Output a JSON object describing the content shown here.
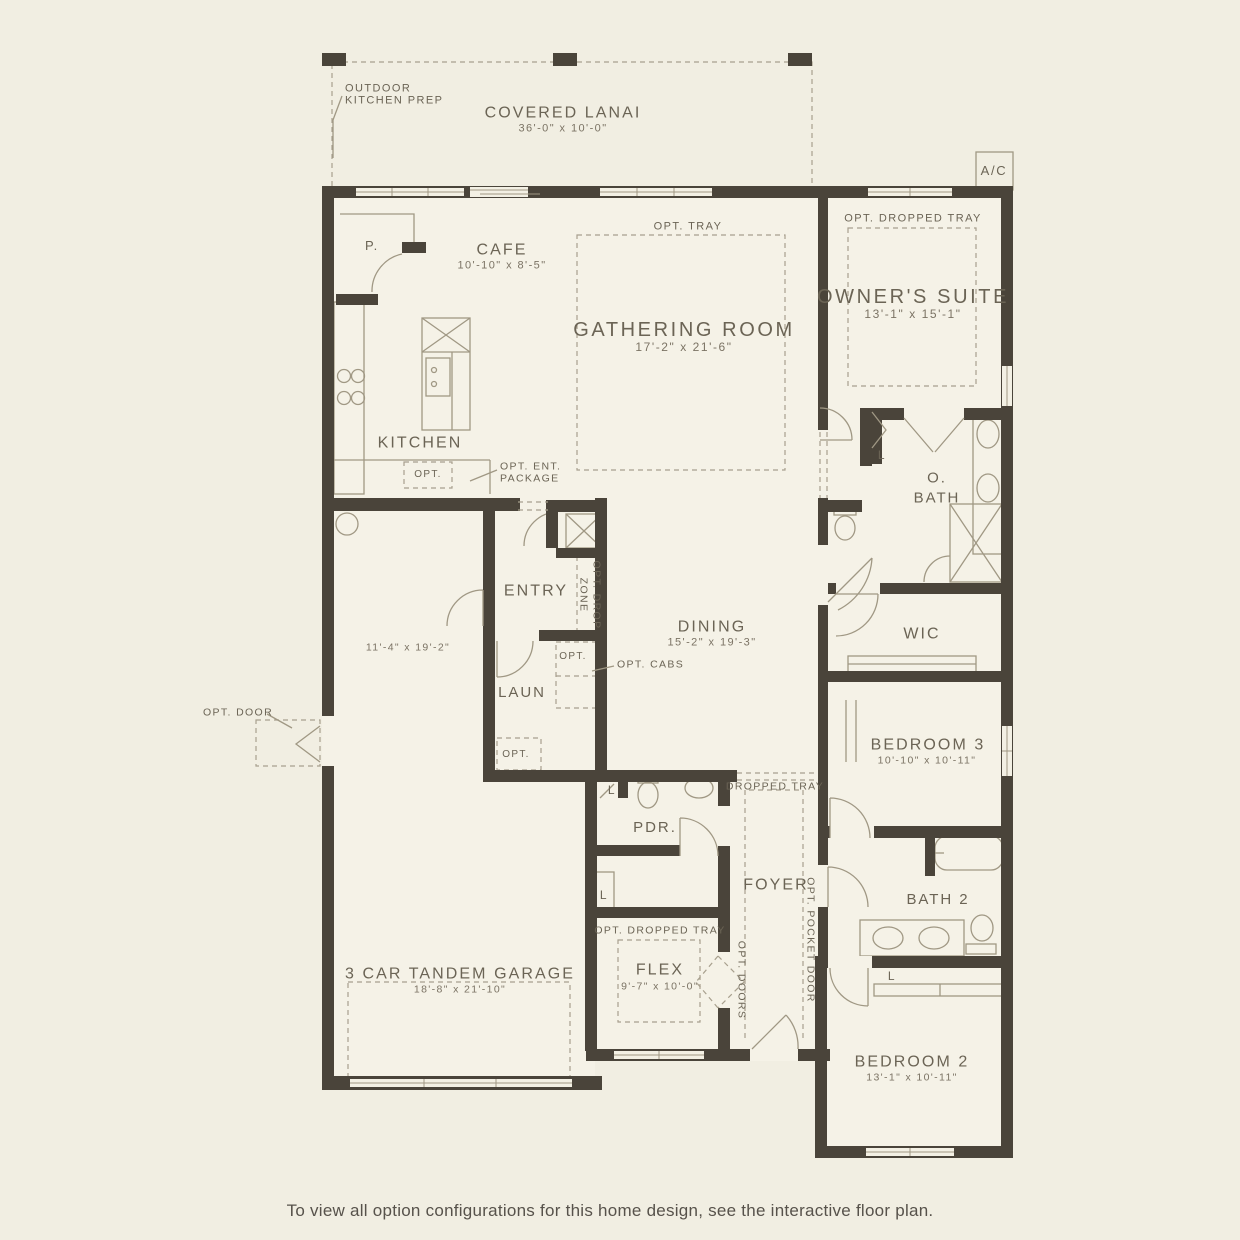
{
  "caption": "To view all option configurations for this home design, see the interactive floor plan.",
  "colors": {
    "background": "#f1eee2",
    "wall": "#4a443a",
    "line": "#a09884",
    "text": "#6b6455"
  },
  "labels": {
    "ac": "A/C",
    "outdoor_kitchen_prep": {
      "line1": "OUTDOOR",
      "line2": "KITCHEN PREP"
    },
    "covered_lanai": {
      "name": "COVERED LANAI",
      "dims": "36'-0\" x 10'-0\""
    },
    "owners_suite": {
      "opt": "OPT. DROPPED TRAY",
      "name": "OWNER'S SUITE",
      "dims": "13'-1\" x 15'-1\""
    },
    "gathering_room": {
      "opt": "OPT. TRAY",
      "name": "GATHERING ROOM",
      "dims": "17'-2\" x 21'-6\""
    },
    "cafe": {
      "name": "CAFE",
      "dims": "10'-10\" x 8'-5\""
    },
    "pantry": "P.",
    "kitchen": {
      "name": "KITCHEN",
      "opt": "OPT.",
      "ent_line1": "OPT. ENT.",
      "ent_line2": "PACKAGE"
    },
    "entry": "ENTRY",
    "drop_zone": {
      "line1": "OPT. DROP",
      "line2": "ZONE"
    },
    "dining": {
      "name": "DINING",
      "dims": "15'-2\" x 19'-3\""
    },
    "o_bath": {
      "line1": "O.",
      "line2": "BATH",
      "linen": "L"
    },
    "wic": "WIC",
    "garage": {
      "name": "3 CAR TANDEM GARAGE",
      "dims": "18'-8\" x 21'-10\"",
      "upper_dims": "11'-4\" x 19'-2\"",
      "opt_door": "OPT. DOOR"
    },
    "laundry": {
      "name": "LAUN",
      "opt_box": "OPT.",
      "opt_cabs": "OPT. CABS",
      "opt": "OPT."
    },
    "bedroom3": {
      "name": "BEDROOM 3",
      "dims": "10'-10\" x 10'-11\""
    },
    "powder": {
      "name": "PDR.",
      "linen": "L"
    },
    "foyer": {
      "name": "FOYER",
      "dropped_tray": "DROPPED TRAY",
      "opt_pocket_door": "OPT. POCKET DOOR"
    },
    "hall_linen": "L",
    "bath2": {
      "name": "BATH 2",
      "linen": "L"
    },
    "flex": {
      "name": "FLEX",
      "dims": "9'-7\" x 10'-0\"",
      "opt_tray": "OPT. DROPPED TRAY",
      "opt_doors": "OPT. DOORS"
    },
    "bedroom2": {
      "name": "BEDROOM 2",
      "dims": "13'-1\" x 10'-11\""
    }
  }
}
